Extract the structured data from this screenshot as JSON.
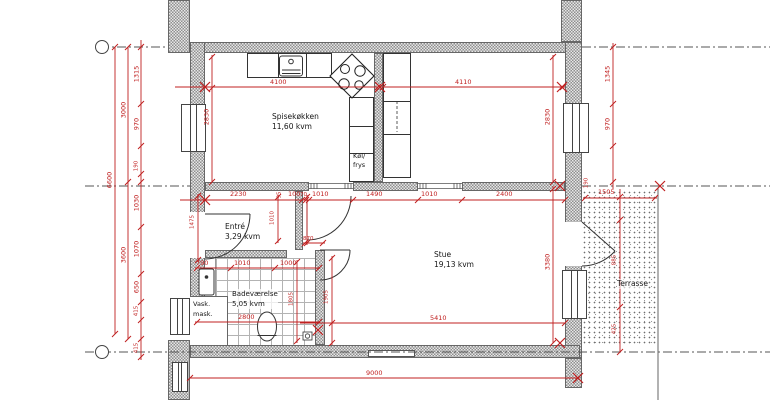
{
  "rooms": [
    {
      "id": "spisekokken",
      "name": "Spisekøkken",
      "area": "11,60 kvm"
    },
    {
      "id": "entre",
      "name": "Entré",
      "area": "3,29 kvm"
    },
    {
      "id": "stue",
      "name": "Stue",
      "area": "19,13 kvm"
    },
    {
      "id": "badevaerelse",
      "name": "Badeværelse",
      "area": "5,05 kvm"
    },
    {
      "id": "terrasse",
      "name": "Terrasse",
      "area": ""
    },
    {
      "id": "kol-frys",
      "name": "Køl/",
      "area": "frys"
    },
    {
      "id": "vask-mask",
      "name": "Vask.",
      "area": "mask."
    }
  ],
  "dimensions": {
    "color": "#c02020",
    "labels": [
      {
        "t": "4100",
        "x": 270,
        "y": 79
      },
      {
        "t": "4110",
        "x": 455,
        "y": 79
      },
      {
        "t": "1505",
        "x": 598,
        "y": 189
      },
      {
        "t": "2230",
        "x": 230,
        "y": 191
      },
      {
        "t": "100",
        "x": 288,
        "y": 191
      },
      {
        "t": "70",
        "x": 300,
        "y": 192,
        "s": 1
      },
      {
        "t": "1010",
        "x": 312,
        "y": 191
      },
      {
        "t": "1490",
        "x": 366,
        "y": 191
      },
      {
        "t": "1010",
        "x": 421,
        "y": 191
      },
      {
        "t": "2400",
        "x": 496,
        "y": 191
      },
      {
        "t": "790",
        "x": 196,
        "y": 260
      },
      {
        "t": "1010",
        "x": 234,
        "y": 260
      },
      {
        "t": "1000",
        "x": 280,
        "y": 260
      },
      {
        "t": "2800",
        "x": 238,
        "y": 314
      },
      {
        "t": "5410",
        "x": 430,
        "y": 315
      },
      {
        "t": "9000",
        "x": 366,
        "y": 370
      },
      {
        "t": "870",
        "x": 303,
        "y": 236,
        "s": 1
      },
      {
        "t": "6600",
        "x": 110,
        "y": 180,
        "r": 1
      },
      {
        "t": "3000",
        "x": 124,
        "y": 110,
        "r": 1
      },
      {
        "t": "3600",
        "x": 124,
        "y": 255,
        "r": 1
      },
      {
        "t": "1315",
        "x": 137,
        "y": 74,
        "r": 1
      },
      {
        "t": "970",
        "x": 137,
        "y": 124,
        "r": 1
      },
      {
        "t": "190",
        "x": 137,
        "y": 166,
        "r": 1,
        "s": 1
      },
      {
        "t": "1030",
        "x": 137,
        "y": 203,
        "r": 1
      },
      {
        "t": "1070",
        "x": 137,
        "y": 249,
        "r": 1
      },
      {
        "t": "650",
        "x": 137,
        "y": 287,
        "r": 1
      },
      {
        "t": "415",
        "x": 137,
        "y": 311,
        "r": 1,
        "s": 1
      },
      {
        "t": "415",
        "x": 137,
        "y": 348,
        "r": 1,
        "s": 1
      },
      {
        "t": "2830",
        "x": 207,
        "y": 117,
        "r": 1
      },
      {
        "t": "2830",
        "x": 548,
        "y": 117,
        "r": 1
      },
      {
        "t": "1345",
        "x": 608,
        "y": 74,
        "r": 1
      },
      {
        "t": "970",
        "x": 608,
        "y": 124,
        "r": 1
      },
      {
        "t": "3380",
        "x": 548,
        "y": 262,
        "r": 1
      },
      {
        "t": "1905",
        "x": 327,
        "y": 297,
        "r": 1,
        "s": 1
      },
      {
        "t": "1805",
        "x": 292,
        "y": 299,
        "r": 1,
        "s": 1
      },
      {
        "t": "1475",
        "x": 193,
        "y": 222,
        "r": 1,
        "s": 1
      },
      {
        "t": "1010",
        "x": 273,
        "y": 218,
        "r": 1,
        "s": 1
      },
      {
        "t": "885",
        "x": 615,
        "y": 260,
        "r": 1,
        "s": 1
      },
      {
        "t": "425",
        "x": 615,
        "y": 329,
        "r": 1,
        "s": 1
      },
      {
        "t": "95",
        "x": 280,
        "y": 195,
        "r": 1,
        "s": 1
      },
      {
        "t": "190",
        "x": 587,
        "y": 183,
        "r": 1,
        "s": 1
      }
    ],
    "hlines": [
      {
        "y": 87,
        "x1": 175,
        "x2": 378,
        "t": [
          205,
          378
        ]
      },
      {
        "y": 87,
        "x1": 383,
        "x2": 565,
        "t": [
          383,
          563
        ]
      },
      {
        "y": 198,
        "x1": 583,
        "x2": 657,
        "t": [
          585,
          655
        ]
      },
      {
        "y": 200,
        "x1": 180,
        "x2": 565,
        "t": [
          205,
          302,
          306,
          309,
          353,
          418,
          462,
          565
        ]
      },
      {
        "y": 268,
        "x1": 195,
        "x2": 320,
        "t": [
          197,
          231,
          275,
          319
        ]
      },
      {
        "y": 322,
        "x1": 195,
        "x2": 320,
        "t": [
          197,
          319
        ]
      },
      {
        "y": 323,
        "x1": 300,
        "x2": 565,
        "t": [
          332,
          565
        ]
      },
      {
        "y": 378,
        "x1": 190,
        "x2": 578,
        "t": [
          190,
          578
        ]
      },
      {
        "y": 243,
        "x1": 303,
        "x2": 325,
        "t": [
          305,
          323
        ]
      }
    ],
    "vlines": [
      {
        "x": 115,
        "y1": 47,
        "y2": 334,
        "t": [
          47,
          334
        ]
      },
      {
        "x": 128,
        "y1": 47,
        "y2": 339,
        "t": [
          47,
          182,
          339
        ]
      },
      {
        "x": 141,
        "y1": 40,
        "y2": 360,
        "t": [
          47,
          104,
          146,
          174,
          182,
          227,
          274,
          302,
          320,
          339,
          357
        ]
      },
      {
        "x": 212,
        "y1": 55,
        "y2": 182,
        "t": [
          57,
          88,
          182
        ]
      },
      {
        "x": 553,
        "y1": 55,
        "y2": 182,
        "t": [
          57,
          182
        ]
      },
      {
        "x": 553,
        "y1": 186,
        "y2": 343,
        "t": [
          189,
          343
        ]
      },
      {
        "x": 613,
        "y1": 43,
        "y2": 189,
        "t": [
          47,
          104,
          146,
          182
        ]
      },
      {
        "x": 620,
        "y1": 189,
        "y2": 352,
        "t": [
          197,
          220,
          307,
          352
        ]
      },
      {
        "x": 332,
        "y1": 256,
        "y2": 345,
        "t": [
          258,
          343
        ]
      },
      {
        "x": 297,
        "y1": 260,
        "y2": 343,
        "t": [
          262,
          341
        ]
      },
      {
        "x": 198,
        "y1": 194,
        "y2": 262,
        "t": [
          196,
          260
        ]
      },
      {
        "x": 278,
        "y1": 195,
        "y2": 243,
        "t": [
          197,
          241
        ]
      },
      {
        "x": 307,
        "y1": 195,
        "y2": 245,
        "t": [
          197,
          243
        ]
      }
    ],
    "crosses": [
      {
        "x": 205,
        "y": 87
      },
      {
        "x": 380,
        "y": 87
      },
      {
        "x": 562,
        "y": 87
      },
      {
        "x": 205,
        "y": 200
      },
      {
        "x": 560,
        "y": 186
      },
      {
        "x": 660,
        "y": 186
      },
      {
        "x": 318,
        "y": 330
      },
      {
        "x": 560,
        "y": 343
      },
      {
        "x": 578,
        "y": 378
      }
    ]
  },
  "grid_axes": {
    "circles": [
      {
        "x": 102,
        "y": 47
      },
      {
        "x": 102,
        "y": 352
      }
    ]
  }
}
